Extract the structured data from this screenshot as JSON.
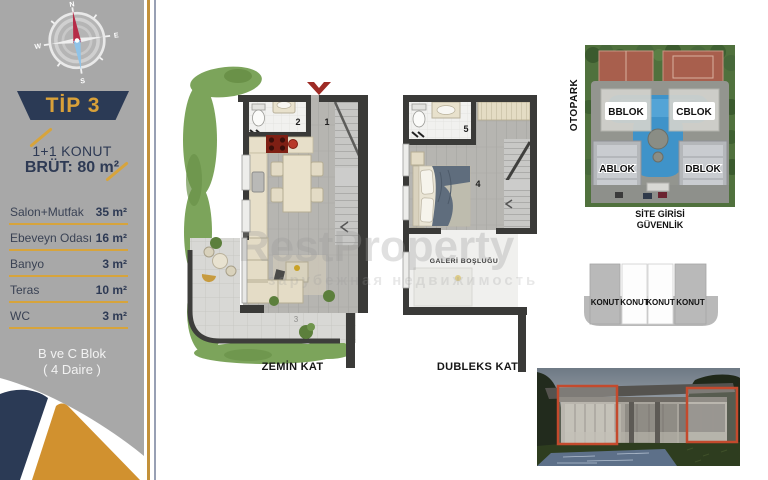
{
  "sidebar": {
    "compass": {
      "n": "N",
      "e": "E",
      "s": "S",
      "w": "W"
    },
    "tip_label": "TİP 3",
    "unit_type": "1+1 KONUT",
    "gross_area": "BRÜT: 80 m²",
    "rooms": [
      {
        "label": "Salon+Mutfak",
        "area": "35 m²"
      },
      {
        "label": "Ebeveyn Odası",
        "area": "16 m²"
      },
      {
        "label": "Banyo",
        "area": "3 m²"
      },
      {
        "label": "Teras",
        "area": "10 m²"
      },
      {
        "label": "WC",
        "area": "3 m²"
      }
    ],
    "block_line1": "B ve C Blok",
    "block_line2": "( 4 Daire )"
  },
  "plans": {
    "ground": {
      "title": "ZEMİN KAT",
      "entry_number": "1",
      "bath_number": "2",
      "terrace_number": "3"
    },
    "duplex": {
      "title": "DUBLEKS KAT",
      "bedroom_number": "4",
      "bath_number": "5",
      "gallery_label": "GALERİ BOŞLUĞU"
    }
  },
  "site_plan": {
    "otopark_label": "OTOPARK",
    "blocks": {
      "b": "BBLOK",
      "c": "CBLOK",
      "a": "ABLOK",
      "d": "DBLOK"
    },
    "entrance_line1": "SİTE GİRİSİ",
    "entrance_line2": "GÜVENLİK"
  },
  "konut_diagram": {
    "units": [
      "KONUT",
      "KONUT",
      "KONUT",
      "KONUT"
    ]
  },
  "watermark": {
    "line1": "RestProperty",
    "line2": "зарубежная недвижимость"
  },
  "colors": {
    "navy": "#2b3a55",
    "gold": "#d7a03a",
    "sidebar_gray": "#a8a8a8",
    "plan_wall": "#3a3a38",
    "accent_red": "#9e2b25",
    "pool_blue": "#3f93c9"
  }
}
